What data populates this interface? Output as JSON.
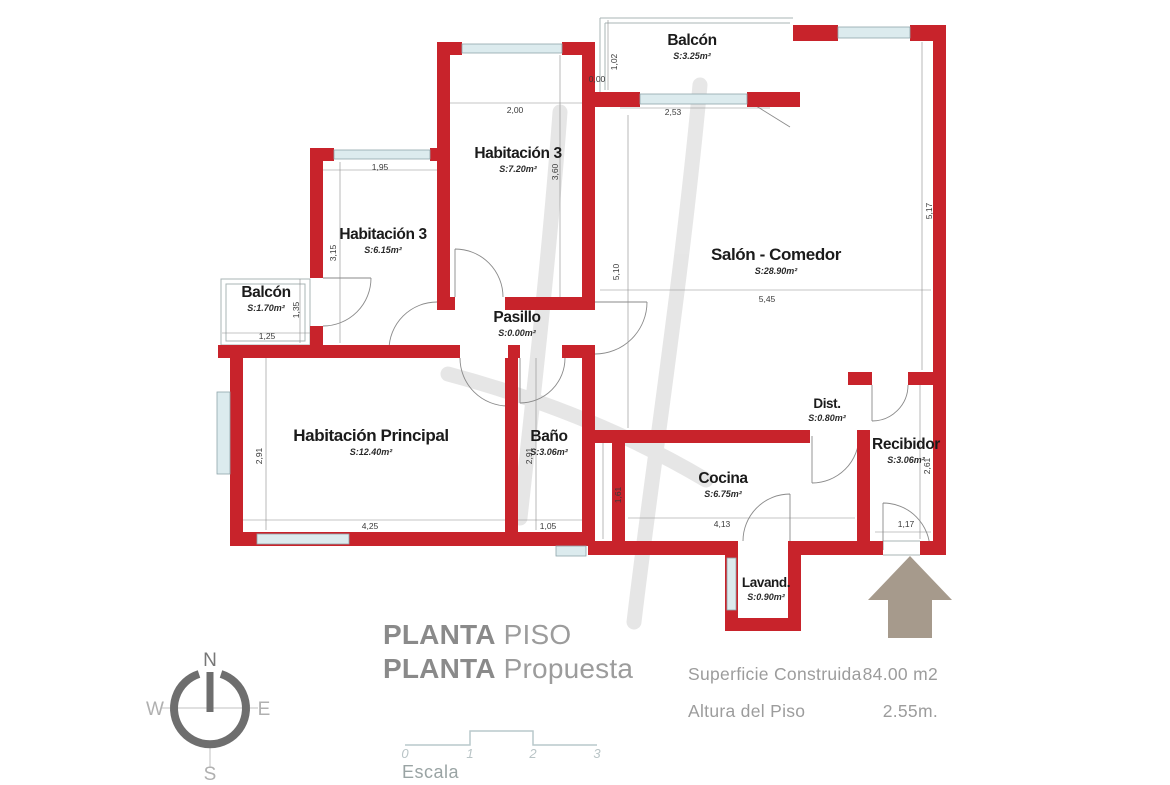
{
  "plan": {
    "rooms": [
      {
        "name": "Balcón",
        "area": "S:3.25m²"
      },
      {
        "name": "Habitación 3",
        "area": "S:7.20m²"
      },
      {
        "name": "Habitación 3",
        "area": "S:6.15m²"
      },
      {
        "name": "Balcón",
        "area": "S:1.70m²"
      },
      {
        "name": "Pasillo",
        "area": "S:0.00m²"
      },
      {
        "name": "Salón - Comedor",
        "area": "S:28.90m²"
      },
      {
        "name": "Habitación Principal",
        "area": "S:12.40m²"
      },
      {
        "name": "Baño",
        "area": "S:3.06m²"
      },
      {
        "name": "Cocina",
        "area": "S:6.75m²"
      },
      {
        "name": "Dist.",
        "area": "S:0.80m²"
      },
      {
        "name": "Recibidor",
        "area": "S:3.06m²"
      },
      {
        "name": "Lavand.",
        "area": "S:0.90m²"
      }
    ],
    "dims": [
      "1,02",
      "0,00",
      "2,53",
      "2,00",
      "3,60",
      "5,10",
      "1,95",
      "3,15",
      "1,25",
      "1,35",
      "5,45",
      "5,17",
      "2,91",
      "4,25",
      "1,05",
      "2,91",
      "1,61",
      "4,13",
      "1,17",
      "2,61"
    ]
  },
  "compass": {
    "north": "N",
    "south": "S",
    "east": "E",
    "west": "W"
  },
  "title": {
    "line1_strong": "PLANTA",
    "line1_rest": "PISO",
    "line2_strong": "PLANTA",
    "line2_rest": "Propuesta"
  },
  "scalebar": {
    "ticks": [
      "0",
      "1",
      "2",
      "3"
    ],
    "label": "Escala"
  },
  "info": [
    {
      "label": "Superficie Construida",
      "value": "84.00 m2"
    },
    {
      "label": "Altura del Piso",
      "value": "2.55m."
    }
  ],
  "colors": {
    "wall_red": "#c8232b",
    "window_blue": "#dcebee",
    "arrow_taupe": "#a69a8c",
    "watermark_gray": "#d7d7d7",
    "annotation_gray": "#9c9c9c"
  }
}
